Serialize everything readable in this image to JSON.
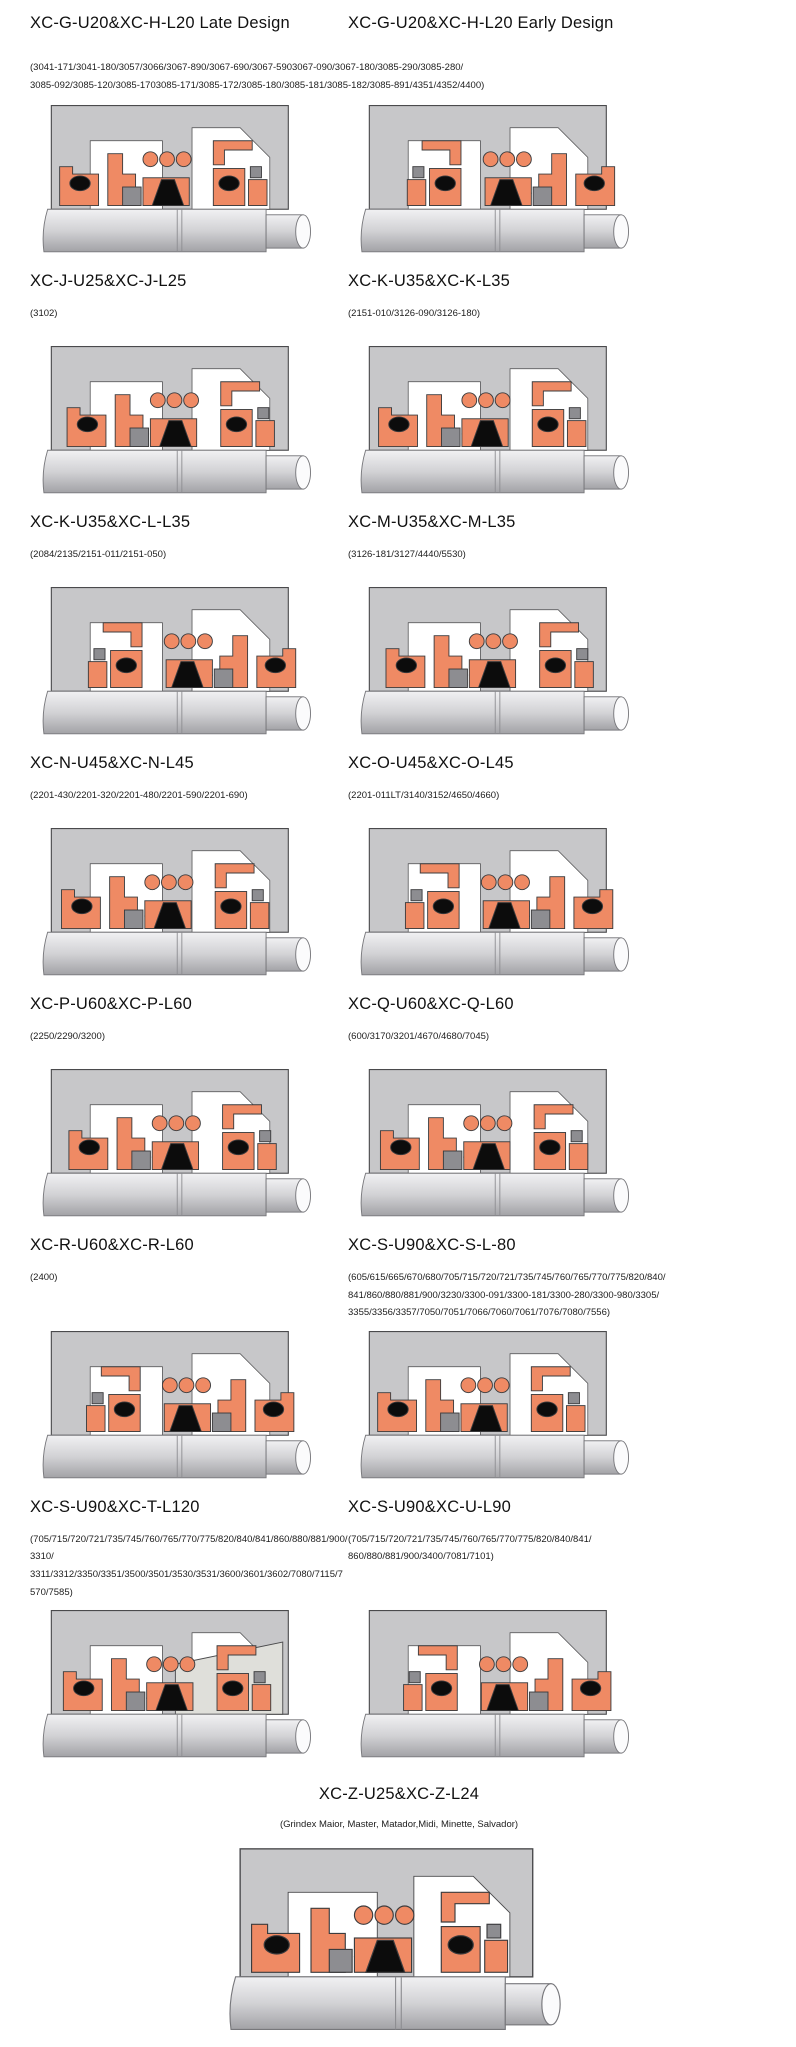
{
  "palette": {
    "housing": "#c7c7c9",
    "outline": "#4a4a4c",
    "seal": "#ef8a64",
    "black": "#0c0c0c",
    "metal": "#8d8d91",
    "shaft_hi": "#f1f1f3",
    "shaft_mid": "#d2d2d5",
    "shaft_lo": "#a2a2a6",
    "background": "#ffffff"
  },
  "rows": [
    {
      "left_title": "XC-G-U20&XC-H-L20 Late Design",
      "right_title": "XC-G-U20&XC-H-L20 Early Design",
      "shared_models": "(3041-171/3041-180/3057/3066/3067-890/3067-690/3067-5903067-090/3067-180/3085-290/3085-280/\n3085-092/3085-120/3085-1703085-171/3085-172/3085-180/3085-181/3085-182/3085-891/4351/4352/4400)"
    },
    {
      "left": {
        "title": "XC-J-U25&XC-J-L25",
        "models": "(3102)"
      },
      "right": {
        "title": "XC-K-U35&XC-K-L35",
        "models": "(2151-010/3126-090/3126-180)"
      }
    },
    {
      "left": {
        "title": "XC-K-U35&XC-L-L35",
        "models": "(2084/2135/2151-011/2151-050)"
      },
      "right": {
        "title": "XC-M-U35&XC-M-L35",
        "models": "(3126-181/3127/4440/5530)"
      }
    },
    {
      "left": {
        "title": "XC-N-U45&XC-N-L45",
        "models": "(2201-430/2201-320/2201-480/2201-590/2201-690)"
      },
      "right": {
        "title": "XC-O-U45&XC-O-L45",
        "models": "(2201-011LT/3140/3152/4650/4660)"
      }
    },
    {
      "left": {
        "title": "XC-P-U60&XC-P-L60",
        "models": "(2250/2290/3200)"
      },
      "right": {
        "title": "XC-Q-U60&XC-Q-L60",
        "models": "(600/3170/3201/4670/4680/7045)"
      }
    },
    {
      "left": {
        "title": "XC-R-U60&XC-R-L60",
        "models": "(2400)"
      },
      "right": {
        "title": "XC-S-U90&XC-S-L-80",
        "models": "(605/615/665/670/680/705/715/720/721/735/745/760/765/770/775/820/840/\n841/860/880/881/900/3230/3300-091/3300-181/3300-280/3300-980/3305/\n3355/3356/3357/7050/7051/7066/7060/7061/7076/7080/7556)"
      }
    },
    {
      "left": {
        "title": "XC-S-U90&XC-T-L120",
        "models": "(705/715/720/721/735/745/760/765/770/775/820/840/841/860/880/881/900/3310/\n3311/3312/3350/3351/3500/3501/3530/3531/3600/3601/3602/7080/7115/7570/7585)"
      },
      "right": {
        "title": "XC-S-U90&XC-U-L90",
        "models": "(705/715/720/721/735/745/760/765/770/775/820/840/841/\n860/880/881/900/3400/7081/7101)"
      }
    }
  ],
  "footer": {
    "title": "XC-Z-U25&XC-Z-L24",
    "models": "(Grindex  Maior, Master, Matador,Midi, Minette, Salvador)"
  }
}
